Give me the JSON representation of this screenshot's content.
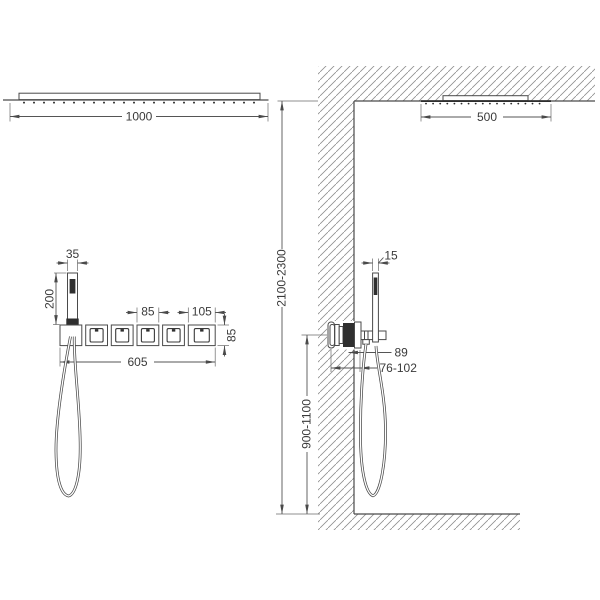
{
  "page": {
    "background": "#ffffff",
    "line_color": "#4a4a4a",
    "hatch_color": "#8f8f8f"
  },
  "front_view": {
    "dims": {
      "head_width": "1000",
      "hand_shower_width": "35",
      "hand_shower_height": "200",
      "valve_module_width": "85",
      "end_module_width": "105",
      "module_height": "85",
      "trim_total_width": "605"
    }
  },
  "side_view": {
    "dims": {
      "head_depth": "500",
      "hand_shower_depth": "15",
      "holder_projection": "89",
      "recess_depth_range": "76-102",
      "valve_height_range": "900-1100",
      "ceiling_height_range": "2100-2300"
    }
  }
}
